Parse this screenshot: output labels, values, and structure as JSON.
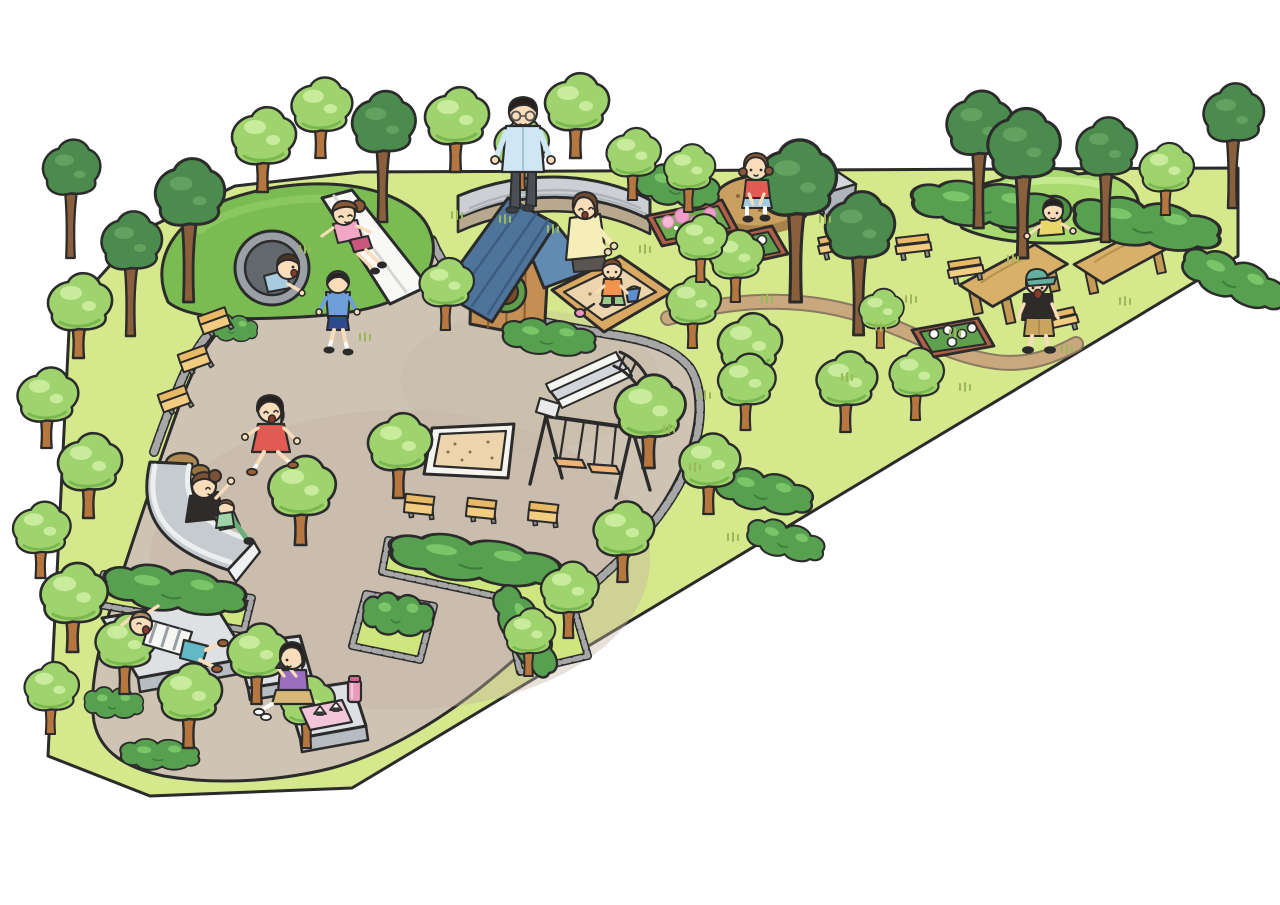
{
  "image": {
    "kind": "cartoon illustration",
    "subject": "Bird's-eye illustrated map of a neighborhood park playground with families playing",
    "background_color": "#ffffff"
  },
  "palette": {
    "grass": "#d6e88c",
    "path": "#cfc4b4",
    "path_shade": "#c2b5a3",
    "dirt_trail": "#c9a87d",
    "curb_stone": "#a7a7a7",
    "hill_green": "#7abc52",
    "mound_green": "#a8da70",
    "hole_green": "#4e9247",
    "tree_light": "#9fd36e",
    "tree_light_hi": "#c8eb9c",
    "tree_dark": "#4c8b4e",
    "trunk": "#b5773f",
    "hedge": "#57a050",
    "hedge_hi": "#7cc468",
    "bench_wood": "#f2cc80",
    "bench_wood_dark": "#e8ba66",
    "table_wood": "#d9b069",
    "planter_wood": "#b06048",
    "flower_pink": "#f4b9d6",
    "flower_white": "#ffffff",
    "stone_light": "#dde1e4",
    "stone_mid": "#b6bcc2",
    "roof_blue": "#4f749b",
    "house_wood": "#c58e52",
    "sand": "#ecd5ac",
    "rock_brown": "#c9a05f",
    "slide_gray": "#c6cbd0",
    "outline": "#2b2b2b",
    "skin": "#f9dcba"
  },
  "scene": {
    "areas": [
      {
        "name": "grass-field",
        "color": "#d6e88c"
      },
      {
        "name": "central-plaza-path",
        "color": "#cfc4b4"
      },
      {
        "name": "dirt-trail",
        "color": "#c9a87d"
      },
      {
        "name": "white-surround",
        "color": "#ffffff"
      }
    ],
    "equipment": [
      "tunnel-hill with white hill slide",
      "play mound with three crawl holes",
      "wooden playhouse with blue gable roof and round window",
      "timber-framed sandbox with toys",
      "large square sand pit",
      "double swing set",
      "metal slide with railed stairs",
      "wide low slide",
      "three stone lounging platforms",
      "curved stone sitting wall",
      "stone block",
      "sitting rock",
      "two wooden picnic tables",
      "benches (three rows plus backed benches)",
      "flower planters (pink and white blossoms)",
      "hedge beds with stone curbs"
    ],
    "people": [
      {
        "id": "girl-on-hill-slide",
        "desc": "girl in pink shirt and magenta shorts sliding down white hill slide"
      },
      {
        "id": "boy-in-tunnel",
        "desc": "boy in light blue shirt crawling out of hill tunnel"
      },
      {
        "id": "boy-walking",
        "desc": "boy in blue hoodie and navy shorts walking on path"
      },
      {
        "id": "man-on-wall",
        "desc": "man with glasses in light blue shirt sitting on stone wall"
      },
      {
        "id": "mother-at-sandbox",
        "desc": "mother in yellow top kneeling at sandbox"
      },
      {
        "id": "toddler-in-sandbox",
        "desc": "toddler in orange shirt playing with bucket and shovel"
      },
      {
        "id": "girl-on-rock",
        "desc": "girl in red shirt squatting on brown rock"
      },
      {
        "id": "kid-in-mound-hole",
        "desc": "child in yellow shirt peeking out of play-mound hole"
      },
      {
        "id": "boy-at-picnic-table",
        "desc": "boy in green cap, black tee and khaki shorts beside picnic tables"
      },
      {
        "id": "girl-running",
        "desc": "girl in red pinafore dress running with arms out"
      },
      {
        "id": "woman-on-wide-slide",
        "desc": "woman in black top with small child riding wide slide"
      },
      {
        "id": "boy-lying-on-platform",
        "desc": "boy in striped shirt lying on stone platform, hands behind head"
      },
      {
        "id": "girl-picnicking",
        "desc": "girl in purple top eating rice balls on stone platform with pink napkin and thermos"
      }
    ],
    "trees": [
      [
        70,
        258,
        0.95,
        "d"
      ],
      [
        188,
        302,
        1.15,
        "d"
      ],
      [
        130,
        336,
        1.0,
        "d"
      ],
      [
        382,
        222,
        1.05,
        "d"
      ],
      [
        795,
        302,
        1.3,
        "d"
      ],
      [
        858,
        335,
        1.15,
        "d"
      ],
      [
        978,
        228,
        1.1,
        "d"
      ],
      [
        1022,
        258,
        1.2,
        "d"
      ],
      [
        1105,
        242,
        1.0,
        "d"
      ],
      [
        1232,
        208,
        1.0,
        "d"
      ],
      [
        262,
        192,
        1.0,
        "l"
      ],
      [
        320,
        158,
        0.95,
        "l"
      ],
      [
        455,
        172,
        1.0,
        "l"
      ],
      [
        520,
        190,
        0.85,
        "l"
      ],
      [
        575,
        158,
        1.0,
        "l"
      ],
      [
        632,
        200,
        0.85,
        "l"
      ],
      [
        688,
        212,
        0.8,
        "l"
      ],
      [
        78,
        358,
        1.0,
        "l"
      ],
      [
        46,
        448,
        0.95,
        "l"
      ],
      [
        88,
        518,
        1.0,
        "l"
      ],
      [
        40,
        578,
        0.9,
        "l"
      ],
      [
        72,
        652,
        1.05,
        "l"
      ],
      [
        124,
        694,
        0.95,
        "l"
      ],
      [
        50,
        734,
        0.85,
        "l"
      ],
      [
        188,
        748,
        1.0,
        "l"
      ],
      [
        256,
        704,
        0.95,
        "l"
      ],
      [
        306,
        748,
        0.85,
        "l"
      ],
      [
        300,
        545,
        1.05,
        "l"
      ],
      [
        398,
        498,
        1.0,
        "l"
      ],
      [
        445,
        330,
        0.85,
        "l"
      ],
      [
        648,
        468,
        1.1,
        "l"
      ],
      [
        708,
        514,
        0.95,
        "l"
      ],
      [
        748,
        398,
        1.0,
        "l"
      ],
      [
        692,
        348,
        0.85,
        "l"
      ],
      [
        622,
        582,
        0.95,
        "l"
      ],
      [
        568,
        638,
        0.9,
        "l"
      ],
      [
        528,
        676,
        0.8,
        "l"
      ],
      [
        745,
        430,
        0.9,
        "l"
      ],
      [
        845,
        432,
        0.95,
        "l"
      ],
      [
        915,
        420,
        0.85,
        "l"
      ],
      [
        735,
        302,
        0.85,
        "l"
      ],
      [
        880,
        348,
        0.7,
        "l"
      ],
      [
        700,
        282,
        0.8,
        "l"
      ],
      [
        1165,
        215,
        0.85,
        "l"
      ]
    ],
    "hedges": [
      {
        "x": 915,
        "y": 186,
        "rot": 6,
        "sx": 1.5,
        "sy": 1.0
      },
      {
        "x": 1078,
        "y": 200,
        "rot": 10,
        "sx": 1.5,
        "sy": 1.05
      },
      {
        "x": 1190,
        "y": 248,
        "rot": 24,
        "sx": 1.1,
        "sy": 0.95
      },
      {
        "x": 640,
        "y": 168,
        "rot": 12,
        "sx": 0.85,
        "sy": 0.9
      },
      {
        "x": 505,
        "y": 322,
        "rot": 8,
        "sx": 0.95,
        "sy": 0.8
      },
      {
        "x": 720,
        "y": 470,
        "rot": 14,
        "sx": 1.0,
        "sy": 0.9
      },
      {
        "x": 752,
        "y": 520,
        "rot": 18,
        "sx": 0.8,
        "sy": 0.8
      },
      {
        "x": 86,
        "y": 692,
        "rot": 6,
        "sx": 0.6,
        "sy": 0.7
      },
      {
        "x": 122,
        "y": 744,
        "rot": 4,
        "sx": 0.8,
        "sy": 0.7
      },
      {
        "x": 210,
        "y": 318,
        "rot": 8,
        "sx": 0.5,
        "sy": 0.6
      },
      {
        "x": 108,
        "y": 568,
        "rot": 9,
        "sx": 1.45,
        "sy": 1.0
      },
      {
        "x": 394,
        "y": 536,
        "rot": 9,
        "sx": 1.75,
        "sy": 1.0
      },
      {
        "x": 512,
        "y": 584,
        "rot": 62,
        "sx": 1.0,
        "sy": 0.9
      },
      {
        "x": 366,
        "y": 598,
        "rot": 10,
        "sx": 0.72,
        "sy": 0.95
      }
    ],
    "benches": [
      [
        196,
        318,
        -32,
        "simple"
      ],
      [
        176,
        356,
        -32,
        "simple"
      ],
      [
        156,
        396,
        -32,
        "simple"
      ],
      [
        404,
        494,
        -6,
        "simple"
      ],
      [
        466,
        498,
        -6,
        "simple"
      ],
      [
        528,
        502,
        -6,
        "simple"
      ],
      [
        818,
        238,
        -14,
        "back"
      ],
      [
        896,
        238,
        -10,
        "back"
      ],
      [
        948,
        262,
        -12,
        "back"
      ],
      [
        1042,
        314,
        -16,
        "back"
      ]
    ],
    "tufts": [
      [
        300,
        252
      ],
      [
        360,
        340
      ],
      [
        452,
        218
      ],
      [
        548,
        232
      ],
      [
        640,
        252
      ],
      [
        700,
        398
      ],
      [
        664,
        432
      ],
      [
        762,
        302
      ],
      [
        820,
        222
      ],
      [
        842,
        380
      ],
      [
        876,
        330
      ],
      [
        906,
        302
      ],
      [
        950,
        336
      ],
      [
        1008,
        262
      ],
      [
        1062,
        352
      ],
      [
        1120,
        304
      ],
      [
        500,
        222
      ],
      [
        728,
        540
      ],
      [
        690,
        470
      ],
      [
        960,
        390
      ]
    ]
  }
}
